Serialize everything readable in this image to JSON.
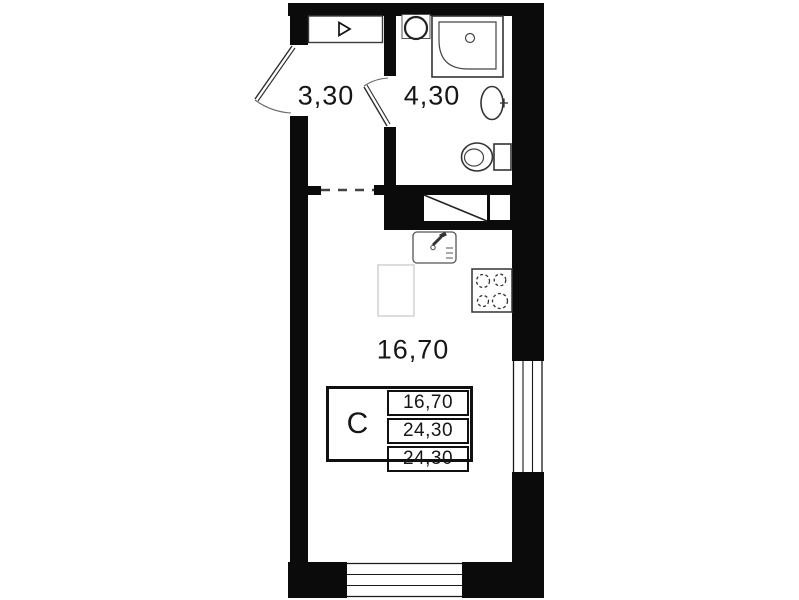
{
  "plan_type": "apartment-floor-plan",
  "rooms": {
    "hall": {
      "label": "3,30"
    },
    "bathroom": {
      "label": "4,30"
    },
    "living": {
      "label": "16,70"
    }
  },
  "legend": {
    "unit_type": "C",
    "values": [
      "16,70",
      "24,30",
      "24,30"
    ]
  },
  "colors": {
    "wall": "#0b0b0b",
    "background": "#ffffff",
    "fixture_stroke": "#333333",
    "faint_outline": "#c6c6c6"
  },
  "icons": {
    "hall_cabinet_arrow": "triangle-right-outline",
    "bathroom_sink": "round-basin",
    "shower": "corner-shower-tray",
    "washbasin": "oval-basin",
    "toilet": "toilet-with-tank",
    "kitchen_sink": "square-sink-with-faucet",
    "stove": "four-burner-hob",
    "vent_shaft": "diagonal-crossed-duct",
    "entry_door": "door-swing-arc",
    "bath_door": "door-swing-arc",
    "window_right": "multi-line-window",
    "window_bottom": "multi-line-window"
  }
}
